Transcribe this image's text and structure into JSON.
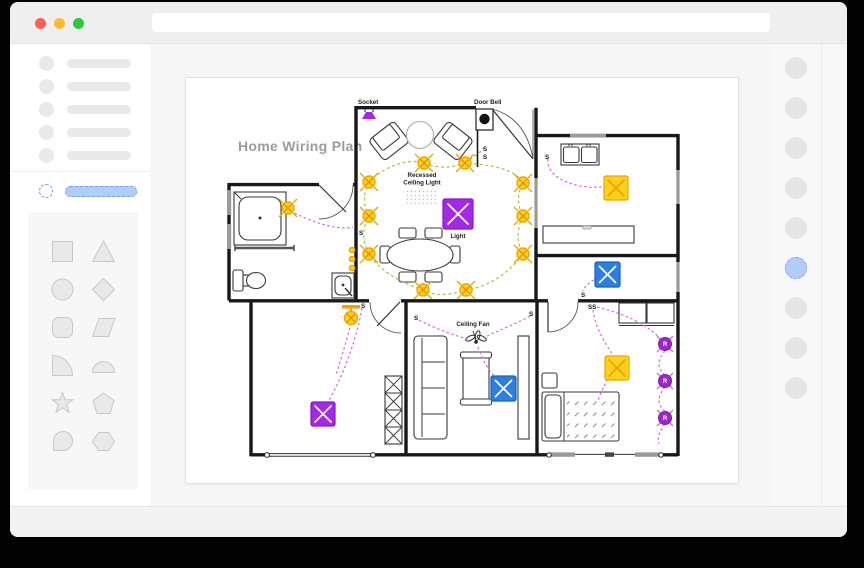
{
  "window": {
    "traffic_lights": [
      "red",
      "yellow",
      "green"
    ]
  },
  "sidebar": {
    "skeleton_item_count": 5,
    "selected_item_highlighted": true,
    "shapes": [
      "square",
      "triangle",
      "circle",
      "diamond",
      "rounded-square",
      "parallelogram",
      "quarter-circle",
      "semicircle",
      "star",
      "pentagon",
      "teardrop",
      "hexagon"
    ]
  },
  "right_panel": {
    "item_count": 9,
    "selected_index": 5
  },
  "plan": {
    "title": "Home Wiring Plan",
    "labels": {
      "socket": "Socket",
      "door_bell": "Door Bell",
      "recessed_1": "Recessed",
      "recessed_2": "Ceiling Light",
      "light": "Light",
      "ceiling_fan": "Ceiling Fan"
    },
    "switch": "S",
    "switch_double": "SS",
    "receptacle": "R"
  },
  "colors": {
    "traffic_red": "#ff5f57",
    "traffic_yellow": "#febc2e",
    "traffic_green": "#2bc840",
    "accent_blue": "#6f9ff3",
    "accent_blue_fill": "#b3cdf9",
    "title_gray": "#9c9c9c",
    "wall": "#181818",
    "symbol_purple": "#a428e8",
    "symbol_purple_dark": "#8a14c9",
    "symbol_yellow": "#ffd21e",
    "symbol_yellow_stroke": "#f0a300",
    "symbol_blue": "#2b7fe3",
    "receptacle_purple": "#9c27c9",
    "wire_green": "#9dc939",
    "wire_purple": "#d66bdc"
  }
}
